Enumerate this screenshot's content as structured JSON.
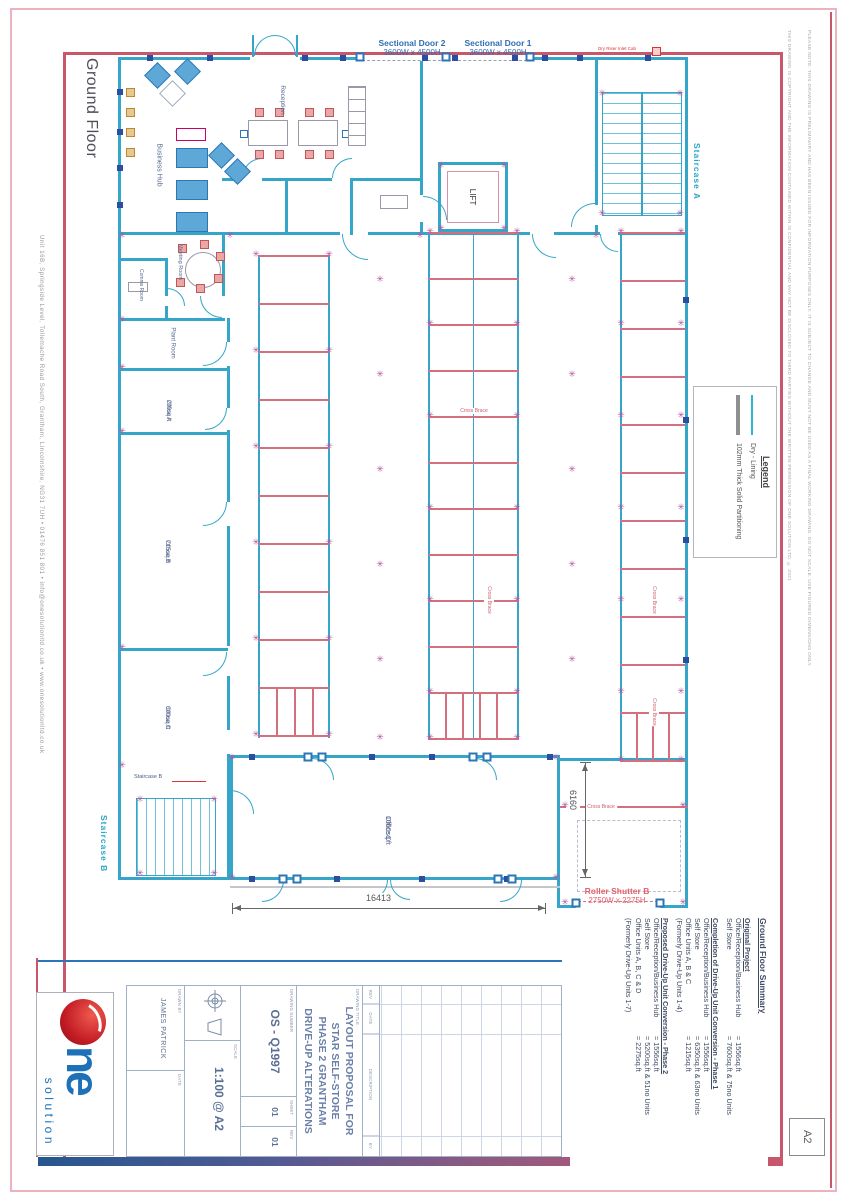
{
  "page": {
    "size_label": "A2"
  },
  "titles": {
    "floor": "Ground Floor"
  },
  "doors": {
    "sectional_door_2": {
      "name": "Sectional Door 2",
      "size": "3600W x 4500H"
    },
    "sectional_door_1": {
      "name": "Sectional Door 1",
      "size": "3600W x 4500H"
    },
    "roller_shutter_b": {
      "name": "Roller Shutter B",
      "size": "2750W x 2275H"
    },
    "dry_riser": "Dry Riser Inlet Cab"
  },
  "stairs": {
    "a": "Staircase A",
    "b": "Staircase B",
    "b_inner": "Staircase B"
  },
  "lift": "LIFT",
  "rooms": {
    "business_hub": "Business Hub",
    "reception": "Reception",
    "meeting_room": "Meeting Room",
    "comms_room": "Comms Room",
    "plant_room": "Plant Room",
    "office_a": {
      "name": "Office A",
      "area": "200sq.ft"
    },
    "office_b": {
      "name": "Office B",
      "area": "715sq.ft"
    },
    "office_c": {
      "name": "Office C",
      "area": "300sq.ft"
    },
    "office_d": {
      "name": "Office D",
      "area": "1060sq.ft"
    }
  },
  "annotations": {
    "cross_brace": "Cross Brace"
  },
  "dimensions": {
    "width": "16413",
    "depth": "6160"
  },
  "legend": {
    "title": "Legend",
    "items": [
      {
        "name": "dry-lining",
        "label": "Dry - Lining"
      },
      {
        "name": "solid-partition",
        "label": "102mm Thick Solid Partitioning"
      }
    ]
  },
  "summary": {
    "heading": "Ground Floor Summary",
    "sections": [
      {
        "heading": "Original Project",
        "rows": [
          [
            "Office/Reception/Business Hub",
            "= 1556sq.ft"
          ],
          [
            "Self Store",
            "= 7600sq.ft & 75no Units"
          ]
        ],
        "note": ""
      },
      {
        "heading": "Completion of Drive-Up Unit Conversion - Phase 1",
        "rows": [
          [
            "Office/Reception/Business Hub",
            "= 1556sq.ft"
          ],
          [
            "Self Store",
            "= 6350sq.ft & 63no Units"
          ],
          [
            "Office Units A, B & C",
            "= 1215sq.ft"
          ]
        ],
        "note": "(Formerly Drive-Up Units 1-4)"
      },
      {
        "heading": "Proposed Drive-Up Unit Conversion - Phase 2",
        "rows": [
          [
            "Office/Reception/Business Hub",
            "= 1556sq.ft"
          ],
          [
            "Self Store",
            "= 5200sq.ft & 51no Units"
          ],
          [
            "Office Units A, B, C & D",
            "= 2275sq.ft"
          ]
        ],
        "note": "(Formerly Drive-Up Units 1-7)"
      }
    ]
  },
  "title_block": {
    "revision_headers": [
      "REV",
      "DATE",
      "DESCRIPTION",
      "BY"
    ],
    "drawing_title_label": "DRAWING TITLE",
    "title_lines": [
      "LAYOUT PROPOSAL FOR",
      "STAR SELF-STORE",
      "PHASE 2 GRANTHAM",
      "DRIVE-UP ALTERATIONS"
    ],
    "fields": {
      "drawing_number_label": "DRAWING NUMBER",
      "drawing_number": "OS - Q1997",
      "sheet_label": "SHEET",
      "sheet": "01",
      "rev_label": "REV",
      "rev": "01",
      "scale_label": "SCALE",
      "scale": "1:100 @ A2",
      "drawn_by_label": "DRAWN BY",
      "drawn_by": "JAMES PATRICK",
      "date_label": "DATE",
      "date": ""
    }
  },
  "brand": {
    "name_fragment": "ne",
    "tagline": "solution"
  },
  "footer_contact": "Unit 16B, Springside Level, Tollemache Road South, Grantham, Lincolnshire, NG31 7UH   •   01476 851 801   •   info@onesolutionltd.co.uk   •   www.onesolutionltd.co.uk",
  "margin_notes": {
    "copyright": "THIS DRAWING IS COPYRIGHT AND THE INFORMATION CONTAINED WITHIN IS CONFIDENTIAL AND MAY NOT BE DISCLOSED TO THIRD PARTIES WITHOUT THE WRITTEN PERMISSION OF ONE SOLUTION LTD. © 2021",
    "note": "PLEASE NOTE: THIS DRAWING IS PRELIMINARY AND HAS BEEN ISSUED FOR INFORMATION PURPOSES ONLY. IT IS SUBJECT TO CHANGE AND MUST NOT BE USED AS A FINAL WORKING DRAWING. DO NOT SCALE. USE FIGURED DIMENSIONS ONLY."
  },
  "colors": {
    "wall_cyan": "#35a6c9",
    "unit_red": "#d4707d",
    "frame_red": "#c9566b",
    "brand_blue": "#1d71b8",
    "label_navy": "#5a6a92",
    "accent_cyan": "#2aa7c8",
    "shutter_red": "#e2606a",
    "column_purple": "#b4549f"
  },
  "plan": {
    "flowers": [
      [
        256,
        255
      ],
      [
        329,
        255
      ],
      [
        256,
        351
      ],
      [
        329,
        351
      ],
      [
        256,
        447
      ],
      [
        329,
        447
      ],
      [
        256,
        543
      ],
      [
        329,
        543
      ],
      [
        256,
        639
      ],
      [
        329,
        639
      ],
      [
        256,
        735
      ],
      [
        329,
        735
      ],
      [
        430,
        232
      ],
      [
        517,
        232
      ],
      [
        430,
        324
      ],
      [
        517,
        324
      ],
      [
        430,
        416
      ],
      [
        517,
        416
      ],
      [
        430,
        508
      ],
      [
        517,
        508
      ],
      [
        430,
        600
      ],
      [
        517,
        600
      ],
      [
        430,
        692
      ],
      [
        517,
        692
      ],
      [
        430,
        738
      ],
      [
        517,
        738
      ],
      [
        621,
        232
      ],
      [
        681,
        232
      ],
      [
        621,
        324
      ],
      [
        681,
        324
      ],
      [
        621,
        416
      ],
      [
        681,
        416
      ],
      [
        621,
        508
      ],
      [
        681,
        508
      ],
      [
        621,
        600
      ],
      [
        681,
        600
      ],
      [
        621,
        692
      ],
      [
        681,
        692
      ],
      [
        621,
        760
      ],
      [
        681,
        760
      ],
      [
        380,
        280
      ],
      [
        380,
        375
      ],
      [
        380,
        470
      ],
      [
        380,
        565
      ],
      [
        380,
        660
      ],
      [
        380,
        738
      ],
      [
        572,
        280
      ],
      [
        572,
        375
      ],
      [
        572,
        470
      ],
      [
        572,
        565
      ],
      [
        572,
        660
      ],
      [
        122,
        236
      ],
      [
        122,
        320
      ],
      [
        122,
        368
      ],
      [
        122,
        432
      ],
      [
        122,
        648
      ],
      [
        122,
        766
      ],
      [
        230,
        236
      ],
      [
        420,
        236
      ],
      [
        596,
        236
      ],
      [
        232,
        758
      ],
      [
        556,
        758
      ],
      [
        232,
        878
      ],
      [
        556,
        878
      ],
      [
        565,
        806
      ],
      [
        683,
        806
      ],
      [
        565,
        903
      ],
      [
        683,
        903
      ],
      [
        441,
        166
      ],
      [
        504,
        166
      ],
      [
        441,
        229
      ],
      [
        504,
        229
      ],
      [
        140,
        800
      ],
      [
        214,
        800
      ],
      [
        140,
        874
      ],
      [
        214,
        874
      ],
      [
        602,
        94
      ],
      [
        680,
        94
      ],
      [
        602,
        214
      ],
      [
        680,
        214
      ]
    ],
    "squares": [
      [
        150,
        58
      ],
      [
        210,
        58
      ],
      [
        305,
        58
      ],
      [
        343,
        58
      ],
      [
        425,
        58
      ],
      [
        455,
        58
      ],
      [
        515,
        58
      ],
      [
        545,
        58
      ],
      [
        580,
        58
      ],
      [
        648,
        58
      ],
      [
        120,
        92
      ],
      [
        120,
        132
      ],
      [
        120,
        168
      ],
      [
        120,
        205
      ],
      [
        252,
        757
      ],
      [
        372,
        757
      ],
      [
        432,
        757
      ],
      [
        550,
        757
      ],
      [
        252,
        879
      ],
      [
        337,
        879
      ],
      [
        422,
        879
      ],
      [
        507,
        879
      ],
      [
        686,
        300
      ],
      [
        686,
        420
      ],
      [
        686,
        540
      ],
      [
        686,
        660
      ]
    ],
    "brackets": [
      [
        308,
        757
      ],
      [
        322,
        757
      ],
      [
        473,
        757
      ],
      [
        487,
        757
      ],
      [
        283,
        879
      ],
      [
        297,
        879
      ],
      [
        498,
        879
      ],
      [
        512,
        879
      ],
      [
        360,
        57
      ],
      [
        446,
        57
      ],
      [
        530,
        57
      ],
      [
        576,
        903
      ],
      [
        660,
        903
      ]
    ]
  }
}
